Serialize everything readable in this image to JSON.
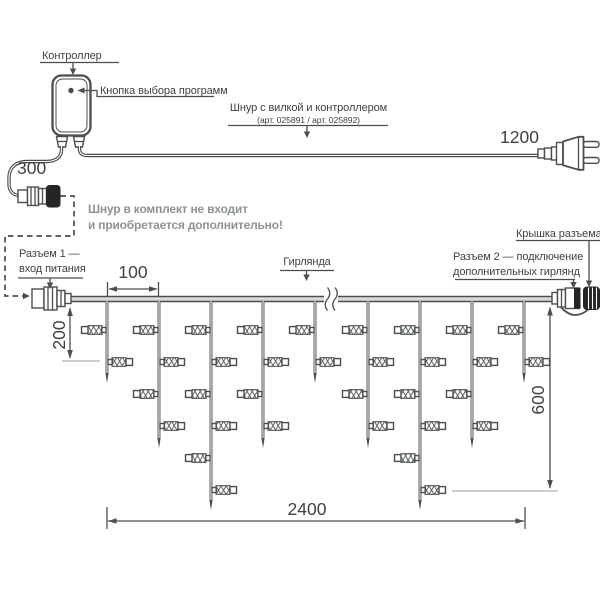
{
  "labels": {
    "controller": "Контроллер",
    "program_button": "Кнопка выбора программ",
    "cord_with_plug_line1": "Шнур с вилкой и контроллером",
    "cord_with_plug_line2": "(арт. 025891 / арт. 025892)",
    "cord_not_included_line1": "Шнур в комплект не входит",
    "cord_not_included_line2": "и приобретается дополнительно!",
    "connector1_line1": "Разъем 1 —",
    "connector1_line2": "вход питания",
    "garland": "Гирлянда",
    "connector_cap": "Крышка разъема",
    "connector2_line1": "Разъем 2 — подключение",
    "connector2_line2": "дополнительных гирлянд"
  },
  "dimensions": {
    "connector_cord": "300",
    "plug_cord": "1200",
    "drop_spacing": "100",
    "first_drop": "200",
    "last_drop": "600",
    "total_width": "2400"
  },
  "garland": {
    "drop_xs": [
      107,
      159,
      211,
      263,
      315,
      368,
      420,
      472,
      524
    ],
    "drop_pattern": [
      "short",
      "medium",
      "long",
      "medium",
      "short",
      "medium",
      "long",
      "medium",
      "short"
    ],
    "lamp_counts": {
      "short": 2,
      "medium": 4,
      "long": 6
    },
    "lamp_row_ys": [
      330,
      362,
      394,
      426,
      458,
      490
    ],
    "tip_ys": {
      "short": 383,
      "medium": 448,
      "long": 510
    }
  },
  "colors": {
    "line": "#4a4e50",
    "text": "#3e4245",
    "muted_text": "#8e9397",
    "dark_fill": "#232527",
    "cable_fill": "#d9dadb",
    "extension_line": "#9c9fa1",
    "background": "#ffffff"
  }
}
